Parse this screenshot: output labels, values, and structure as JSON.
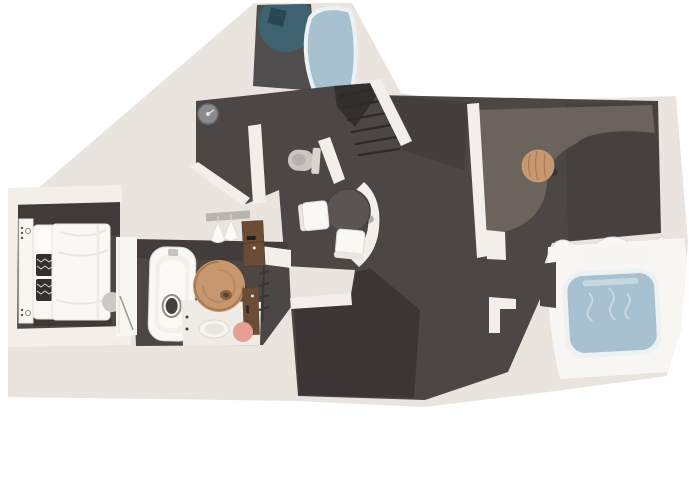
{
  "scene": {
    "type": "3d-floorplan-render",
    "rooms": [
      "entry-foyer",
      "hallway-wc",
      "staircase",
      "bedroom",
      "bathroom",
      "walk-in-closet",
      "dining-area",
      "living-room",
      "master-bathroom",
      "storage-room"
    ],
    "furniture": [
      "top-bathtub",
      "teal-round-rug",
      "decor-box",
      "wall-clock",
      "toilet",
      "double-bed",
      "patterned-cushions",
      "bedside-panel",
      "gray-pouf",
      "white-bathtub",
      "rattan-round-rug",
      "wood-vanity",
      "towel-ladder",
      "bath-mat",
      "soap-tray",
      "pink-stool",
      "clothes-hangers",
      "wardrobe-cabinet",
      "dining-table",
      "dining-chair-left",
      "dining-chair-bottom",
      "area-rug",
      "round-wood-table",
      "sofa",
      "blue-bathtub",
      "tub-ledge"
    ]
  },
  "colors": {
    "background": "#ffffff",
    "plate": "#e9e4de",
    "wall_white": "#f2efea",
    "wall_bright": "#f8f6f2",
    "floor_dark": "#4c4644",
    "floor_darker": "#3a3533",
    "floor_light_rug": "#6e6761",
    "water_blue": "#a7c1d0",
    "teal_rug": "#3e6270",
    "navy_box": "#2a4854",
    "wood_tan": "#c79770",
    "wood_dark": "#6b4c37",
    "white_furniture": "#faf8f5",
    "furniture_shadow": "#d8d3cc",
    "table_top": "#5a5552",
    "toilet_gray": "#c9c6c2",
    "rail_gray": "#b7b4b0",
    "pink_accent": "#e6a093",
    "mat_white": "#efece7",
    "step_line": "#2e2a28"
  }
}
